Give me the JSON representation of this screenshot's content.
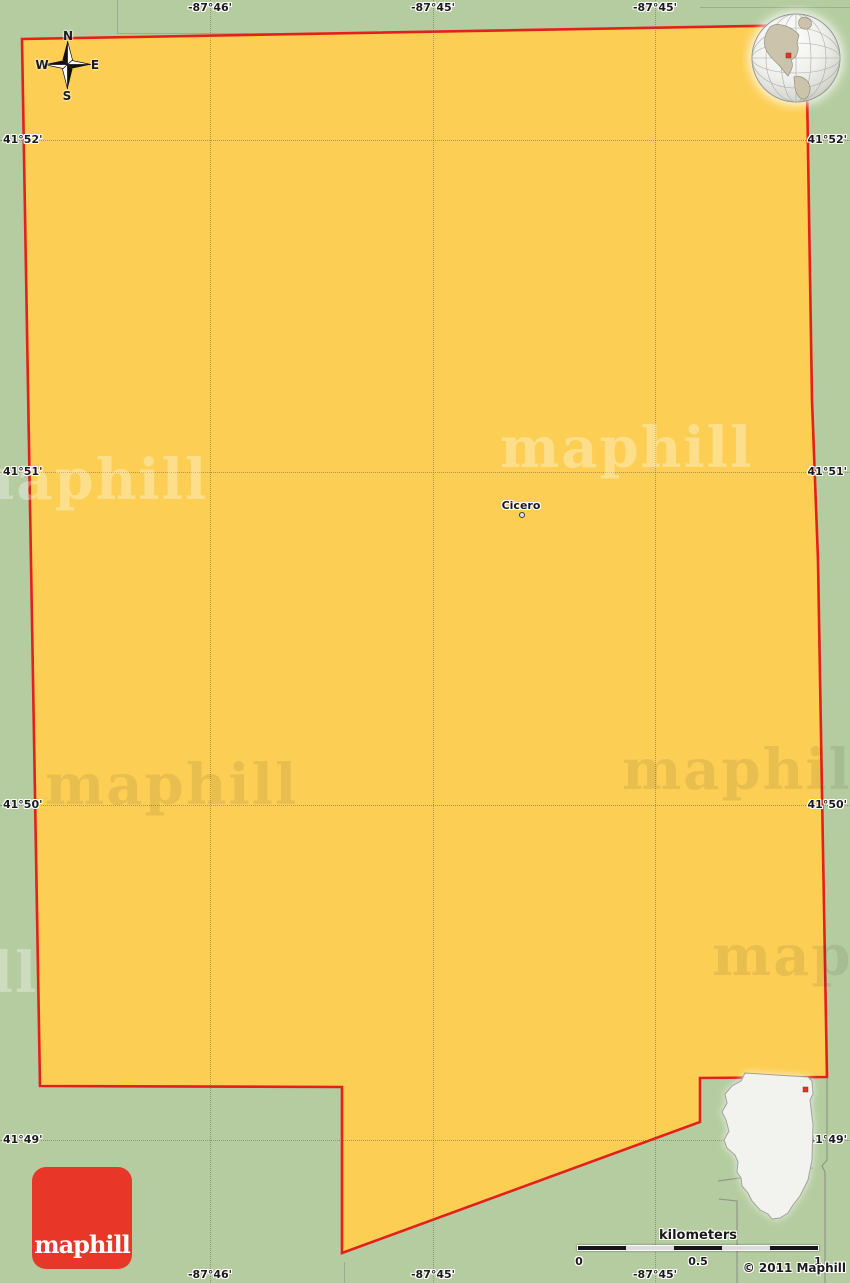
{
  "map": {
    "place": {
      "label": "Cicero"
    },
    "compass": {
      "n": "N",
      "e": "E",
      "s": "S",
      "w": "W"
    },
    "graticule": {
      "top": [
        "-87°46'",
        "-87°45'",
        "-87°45'"
      ],
      "bottom": [
        "-87°46'",
        "-87°45'",
        "-87°45'"
      ],
      "left": [
        "41°52'",
        "41°51'",
        "41°50'",
        "41°49'"
      ],
      "right": [
        "41°52'",
        "41°51'",
        "41°50'",
        "41°49'"
      ]
    },
    "watermark_text": "maphill",
    "logo_text": "maphill",
    "copyright": "© 2011 Maphill",
    "scalebar": {
      "unit": "kilometers",
      "ticks": [
        "0",
        "0.5",
        "1"
      ]
    },
    "colors": {
      "surrounding_land": "#b5cca0",
      "region_fill": "#fcce54",
      "region_border": "#e3201a",
      "logo_red": "#e83728",
      "marker_red": "#d8372a",
      "inset_fill": "#f2f2ef"
    }
  }
}
